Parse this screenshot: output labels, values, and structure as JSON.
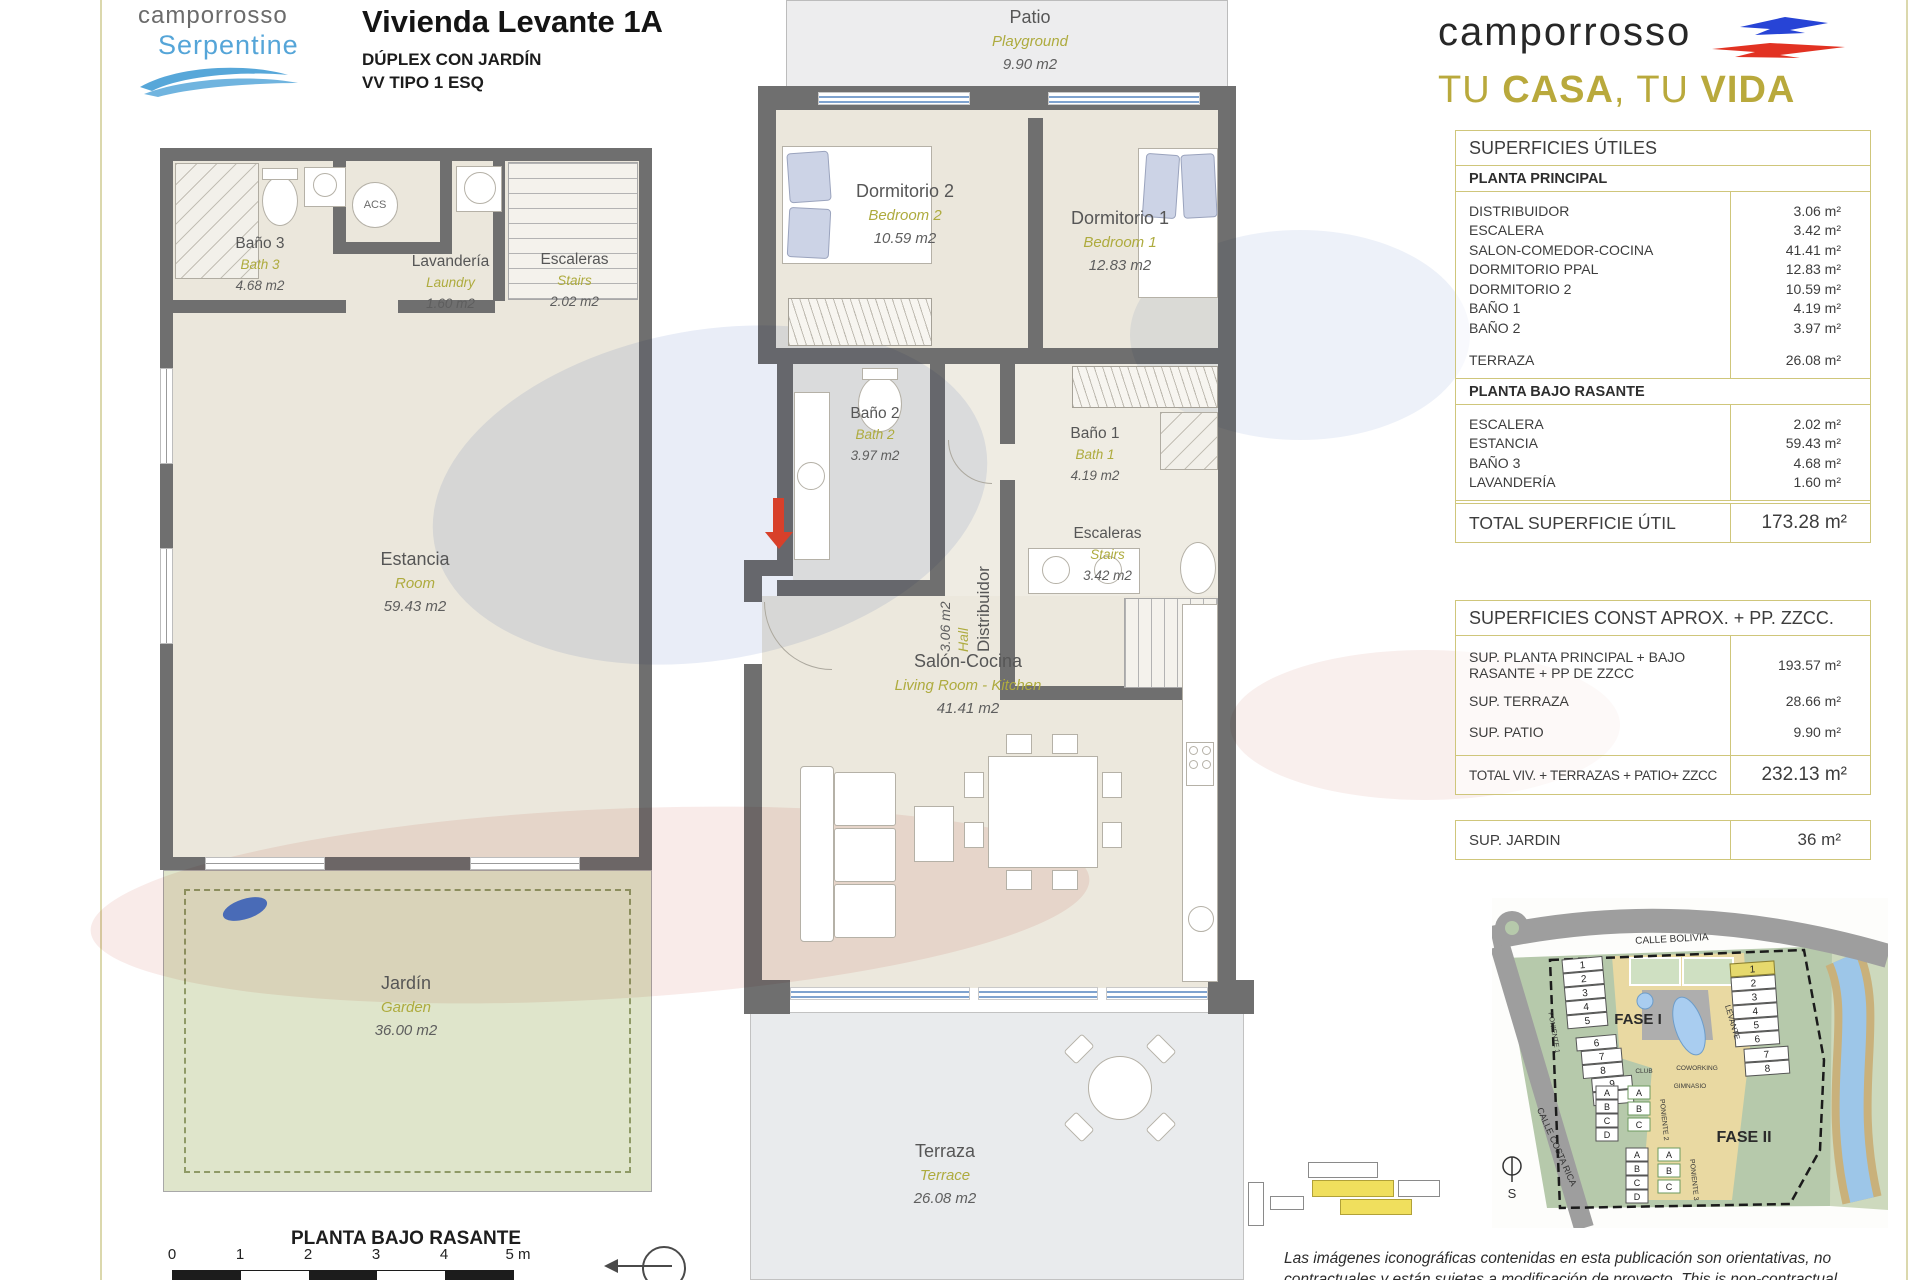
{
  "brand_left": {
    "line1": "camporrosso",
    "line2": "Serpentine"
  },
  "title_block": {
    "title": "Vivienda Levante 1A",
    "subtitle1": "DÚPLEX CON JARDÍN",
    "subtitle2": "VV TIPO 1 ESQ"
  },
  "brand_right": {
    "name": "camporrosso",
    "tagline": {
      "t1": "TU ",
      "b1": "CASA",
      "t2": ", TU ",
      "b2": "VIDA"
    }
  },
  "plan_lower": {
    "caption": "PLANTA BAJO RASANTE",
    "rooms": {
      "bano3": {
        "name": "Baño 3",
        "en": "Bath 3",
        "area": "4.68 m2"
      },
      "lavanderia": {
        "name": "Lavandería",
        "en": "Laundry",
        "area": "1.60 m2"
      },
      "escaleras": {
        "name": "Escaleras",
        "en": "Stairs",
        "area": "2.02 m2"
      },
      "estancia": {
        "name": "Estancia",
        "en": "Room",
        "area": "59.43 m2"
      },
      "jardin": {
        "name": "Jardín",
        "en": "Garden",
        "area": "36.00 m2"
      },
      "acs": "ACS"
    }
  },
  "plan_main": {
    "rooms": {
      "patio": {
        "name": "Patio",
        "en": "Playground",
        "area": "9.90 m2"
      },
      "dorm2": {
        "name": "Dormitorio 2",
        "en": "Bedroom 2",
        "area": "10.59 m2"
      },
      "dorm1": {
        "name": "Dormitorio 1",
        "en": "Bedroom 1",
        "area": "12.83 m2"
      },
      "bano2": {
        "name": "Baño 2",
        "en": "Bath 2",
        "area": "3.97 m2"
      },
      "bano1": {
        "name": "Baño 1",
        "en": "Bath 1",
        "area": "4.19 m2"
      },
      "distribuidor": {
        "name": "Distribuidor",
        "en": "Hall",
        "area": "3.06 m2"
      },
      "escaleras": {
        "name": "Escaleras",
        "en": "Stairs",
        "area": "3.42 m2"
      },
      "salon": {
        "name": "Salón-Cocina",
        "en": "Living Room - Kitchen",
        "area": "41.41 m2"
      },
      "terraza": {
        "name": "Terraza",
        "en": "Terrace",
        "area": "26.08 m2"
      }
    }
  },
  "tables": {
    "utiles": {
      "title": "SUPERFICIES ÚTILES",
      "section1": {
        "header": "PLANTA PRINCIPAL",
        "rows": [
          {
            "label": "DISTRIBUIDOR",
            "value": "3.06 m²"
          },
          {
            "label": "ESCALERA",
            "value": "3.42 m²"
          },
          {
            "label": "SALON-COMEDOR-COCINA",
            "value": "41.41 m²"
          },
          {
            "label": "DORMITORIO PPAL",
            "value": "12.83 m²"
          },
          {
            "label": "DORMITORIO 2",
            "value": "10.59 m²"
          },
          {
            "label": "BAÑO 1",
            "value": "4.19 m²"
          },
          {
            "label": "BAÑO 2",
            "value": "3.97 m²"
          },
          {
            "label": "TERRAZA",
            "value": "26.08 m²"
          }
        ]
      },
      "section2": {
        "header": "PLANTA BAJO RASANTE",
        "rows": [
          {
            "label": "ESCALERA",
            "value": "2.02 m²"
          },
          {
            "label": "ESTANCIA",
            "value": "59.43 m²"
          },
          {
            "label": "BAÑO 3",
            "value": "4.68 m²"
          },
          {
            "label": "LAVANDERÍA",
            "value": "1.60 m²"
          }
        ]
      },
      "total": {
        "label": "TOTAL SUPERFICIE ÚTIL",
        "value": "173.28 m²"
      }
    },
    "construidas": {
      "title": "SUPERFICIES CONST APROX. + PP. ZZCC.",
      "rows": [
        {
          "label": "SUP. PLANTA PRINCIPAL + BAJO RASANTE + PP DE ZZCC",
          "value": "193.57 m²"
        },
        {
          "label": "SUP. TERRAZA",
          "value": "28.66 m²"
        },
        {
          "label": "SUP. PATIO",
          "value": "9.90 m²"
        }
      ],
      "total": {
        "label": "TOTAL VIV. + TERRAZAS + PATIO+ ZZCC",
        "value": "232.13 m²"
      }
    },
    "jardin": {
      "label": "SUP. JARDIN",
      "value": "36 m²"
    }
  },
  "scalebar": {
    "ticks": [
      "0",
      "1",
      "2",
      "3",
      "4",
      "5 m"
    ]
  },
  "sitemap": {
    "street_top": "CALLE BOLIVIA",
    "street_left": "CALLE COSTA RICA",
    "fase1": "FASE I",
    "fase2": "FASE II",
    "levante": "LEVANTE",
    "poniente1": "PONIENTE 1",
    "poniente2": "PONIENTE 2",
    "poniente3": "PONIENTE 3",
    "club": "CLUB",
    "coworking": "COWORKING",
    "gimnasio": "GIMNASIO",
    "compass": "S",
    "left_numbers": [
      "1",
      "2",
      "3",
      "4",
      "5",
      "6",
      "7",
      "8",
      "9",
      "10"
    ],
    "right_numbers": [
      "1",
      "2",
      "3",
      "4",
      "5",
      "6",
      "7",
      "8"
    ],
    "letters": [
      "A",
      "B",
      "C",
      "D"
    ]
  },
  "disclaimer": {
    "line1": "Las imágenes iconográficas contenidas en esta publicación son orientativas, no",
    "line2": "contractuales y están sujetas a modificación de proyecto. This is non-contractual"
  }
}
